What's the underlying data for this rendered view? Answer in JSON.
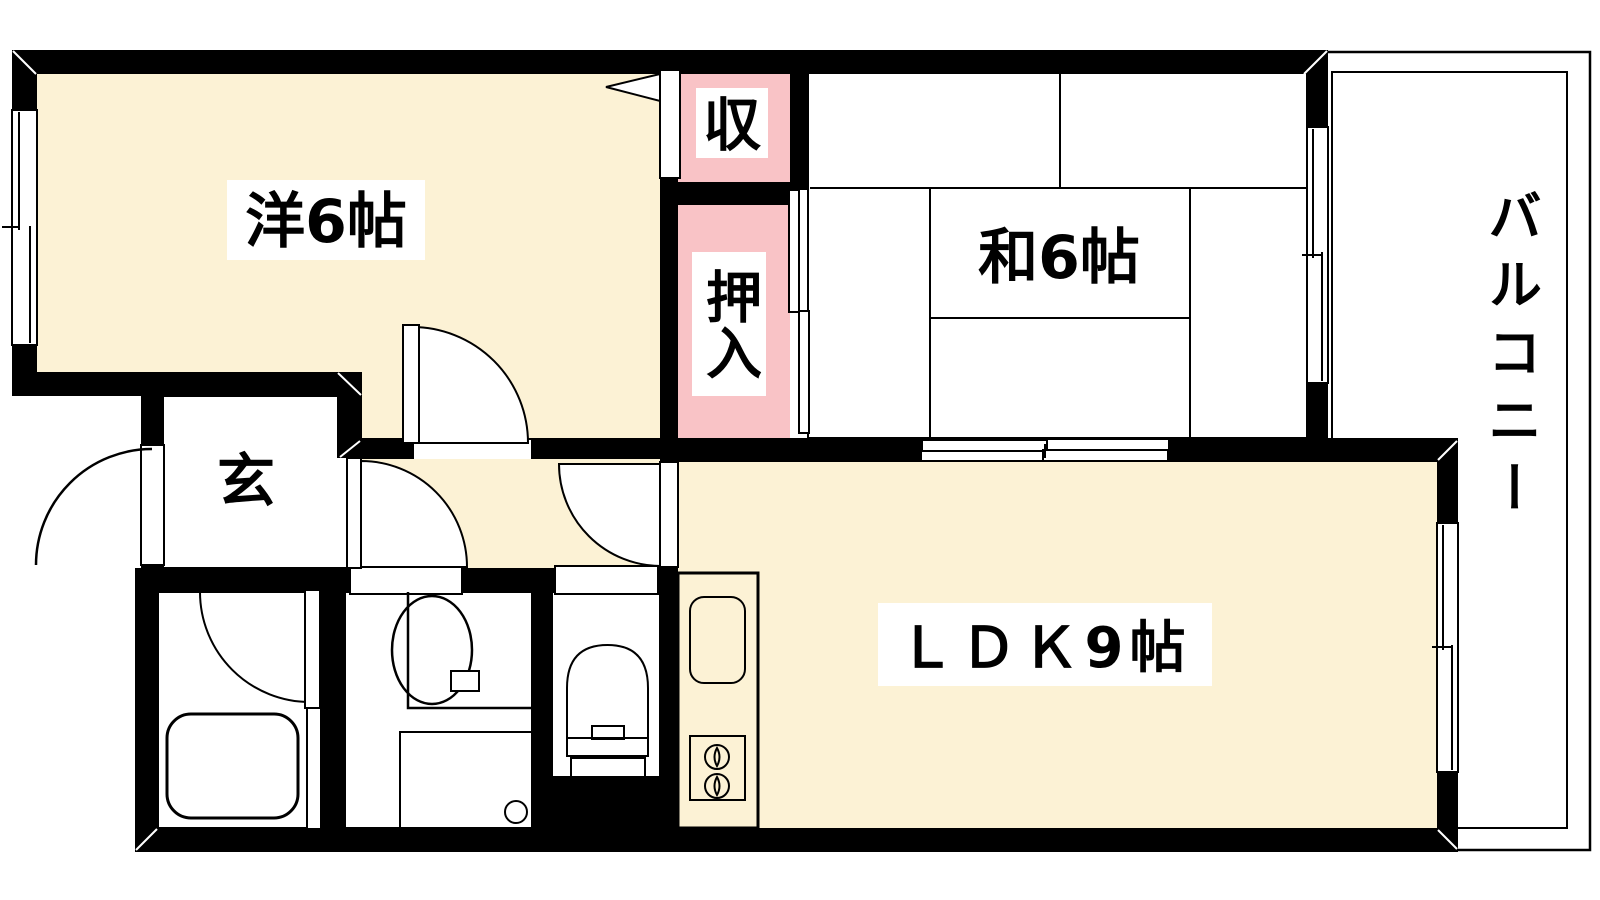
{
  "title": "1LDK+2 room Japanese apartment floor plan",
  "rooms": {
    "western": {
      "label": "洋6帖"
    },
    "japanese": {
      "label": "和6帖"
    },
    "ldk": {
      "label": "ＬＤＫ9帖"
    },
    "storage": {
      "label": "収"
    },
    "closet": {
      "label": "押入"
    },
    "entrance": {
      "label": "玄"
    },
    "balcony": {
      "label": "バルコニー"
    }
  },
  "colors": {
    "wall": "#000000",
    "floor_cream": "#fcf2d5",
    "tatami_green": "#d4e7cf",
    "closet_pink": "#f9c3c6",
    "wet_area_blue": "#d9e9fb",
    "kitchen_purple": "#e7e0f4",
    "entrance_gray": "#d2d2d2",
    "balcony_gray": "#d4d4d4",
    "label_bg": "#ffffff"
  }
}
